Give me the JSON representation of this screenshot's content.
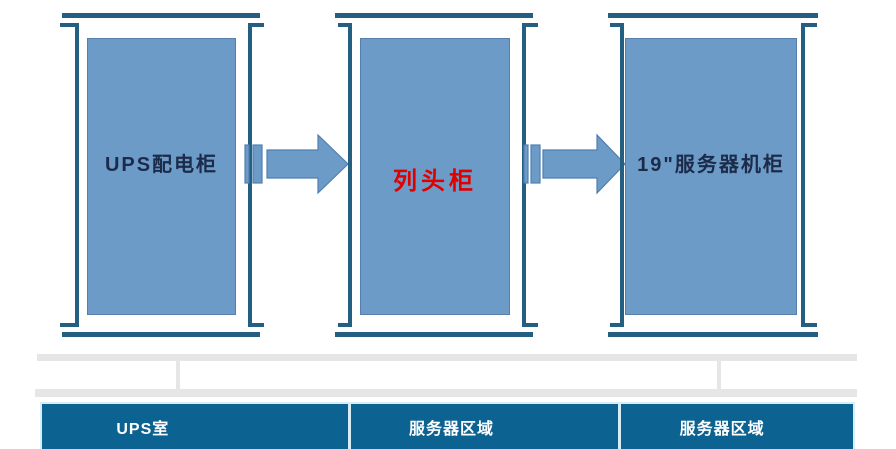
{
  "cabinets": [
    {
      "id": "ups-distribution-cabinet",
      "label": "UPS配电柜",
      "label_color": "#1c2b4a"
    },
    {
      "id": "row-head-cabinet",
      "label": "列头柜",
      "label_color": "#e00000"
    },
    {
      "id": "server-rack-19inch",
      "label": "19\"服务器机柜",
      "label_color": "#1c2b4a"
    }
  ],
  "arrows": [
    {
      "name": "striped-right-arrow",
      "direction": "right"
    },
    {
      "name": "striped-right-arrow",
      "direction": "right"
    }
  ],
  "zones": [
    {
      "label": "UPS室"
    },
    {
      "label": "服务器区域"
    },
    {
      "label": "服务器区域"
    }
  ],
  "colors": {
    "cabinet_fill": "#6d9bc7",
    "cabinet_border": "#567fae",
    "frame_line": "#245e80",
    "arrow_fill": "#6d9bc7",
    "arrow_outline": "#4f7fb2",
    "zone_bar_fill": "#0c6392",
    "zone_bar_divider": "#d8eef6",
    "zone_text": "#ffffff",
    "connector_gray": "#e6e6e6",
    "background": "#ffffff"
  }
}
